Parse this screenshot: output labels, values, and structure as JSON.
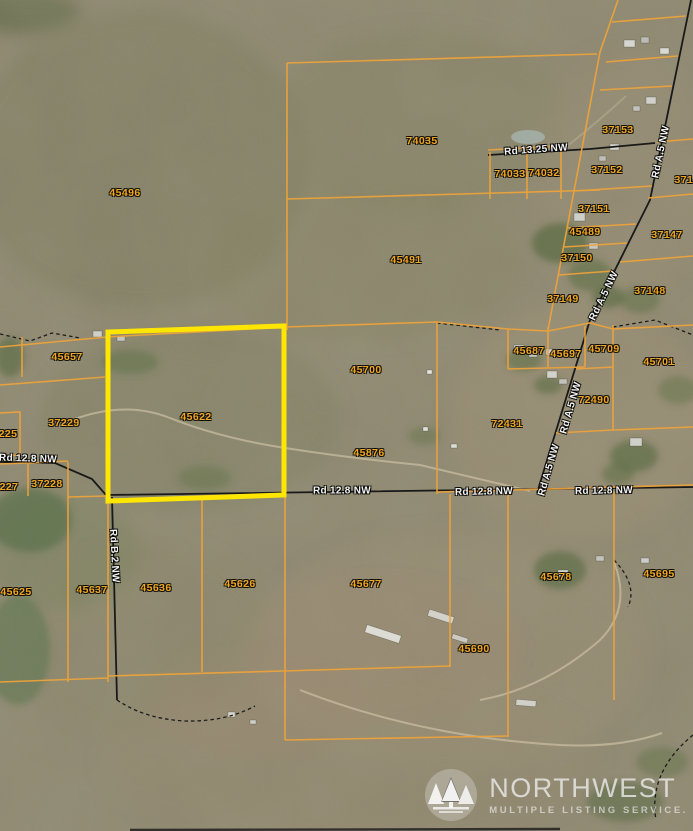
{
  "map": {
    "type": "aerial-parcel-map",
    "subject_parcel": "45622",
    "colors": {
      "parcel_line": "#eda33a",
      "subject_highlight": "#ffe600",
      "road_line": "#191919",
      "parcel_text": "#f2a71f",
      "road_text": "#f4f4f4"
    },
    "parcel_labels": [
      {
        "text": "45496",
        "x": 125,
        "y": 193
      },
      {
        "text": "74035",
        "x": 422,
        "y": 141
      },
      {
        "text": "74033",
        "x": 510,
        "y": 174
      },
      {
        "text": "74032",
        "x": 544,
        "y": 173
      },
      {
        "text": "37153",
        "x": 618,
        "y": 130
      },
      {
        "text": "37152",
        "x": 607,
        "y": 170
      },
      {
        "text": "3714",
        "x": 687,
        "y": 180
      },
      {
        "text": "37151",
        "x": 594,
        "y": 209
      },
      {
        "text": "45489",
        "x": 585,
        "y": 232
      },
      {
        "text": "37147",
        "x": 667,
        "y": 235
      },
      {
        "text": "37150",
        "x": 577,
        "y": 258
      },
      {
        "text": "37148",
        "x": 650,
        "y": 291
      },
      {
        "text": "37149",
        "x": 563,
        "y": 299
      },
      {
        "text": "45491",
        "x": 406,
        "y": 260
      },
      {
        "text": "45657",
        "x": 67,
        "y": 357
      },
      {
        "text": "45687",
        "x": 529,
        "y": 351
      },
      {
        "text": "45697",
        "x": 566,
        "y": 354
      },
      {
        "text": "45709",
        "x": 604,
        "y": 349
      },
      {
        "text": "45701",
        "x": 659,
        "y": 362
      },
      {
        "text": "45700",
        "x": 366,
        "y": 370
      },
      {
        "text": "72490",
        "x": 594,
        "y": 400
      },
      {
        "text": "72431",
        "x": 507,
        "y": 424
      },
      {
        "text": "45622",
        "x": 196,
        "y": 417
      },
      {
        "text": "37229",
        "x": 64,
        "y": 423
      },
      {
        "text": "225",
        "x": 8,
        "y": 434
      },
      {
        "text": "37228",
        "x": 47,
        "y": 484
      },
      {
        "text": "227",
        "x": 9,
        "y": 487
      },
      {
        "text": "45876",
        "x": 369,
        "y": 453
      },
      {
        "text": "45625",
        "x": 16,
        "y": 592
      },
      {
        "text": "45637",
        "x": 92,
        "y": 590
      },
      {
        "text": "45636",
        "x": 156,
        "y": 588
      },
      {
        "text": "45626",
        "x": 240,
        "y": 584
      },
      {
        "text": "45677",
        "x": 366,
        "y": 584
      },
      {
        "text": "45678",
        "x": 556,
        "y": 577
      },
      {
        "text": "45695",
        "x": 659,
        "y": 574
      },
      {
        "text": "45690",
        "x": 474,
        "y": 649
      }
    ],
    "road_labels": [
      {
        "text": "Rd 13.25 NW",
        "x": 536,
        "y": 150,
        "angle": -4
      },
      {
        "text": "Rd A.5 NW",
        "x": 661,
        "y": 152,
        "angle": -78
      },
      {
        "text": "Rd A.5 NW",
        "x": 604,
        "y": 296,
        "angle": -64
      },
      {
        "text": "Rd A.5 NW",
        "x": 571,
        "y": 408,
        "angle": -74
      },
      {
        "text": "Rd A.5 NW",
        "x": 549,
        "y": 470,
        "angle": -74
      },
      {
        "text": "Rd 12.8 NW",
        "x": 28,
        "y": 459,
        "angle": 2
      },
      {
        "text": "Rd 12.8 NW",
        "x": 342,
        "y": 491,
        "angle": 0
      },
      {
        "text": "Rd 12.8 NW",
        "x": 484,
        "y": 492,
        "angle": -1
      },
      {
        "text": "Rd 12.8 NW",
        "x": 604,
        "y": 491,
        "angle": -1
      },
      {
        "text": "Rd B.2 NW",
        "x": 114,
        "y": 556,
        "angle": 87
      }
    ],
    "watermark": {
      "logo_icon": "pine-trees-icon",
      "name": "NORTHWEST",
      "tagline": "MULTIPLE LISTING SERVICE."
    }
  }
}
